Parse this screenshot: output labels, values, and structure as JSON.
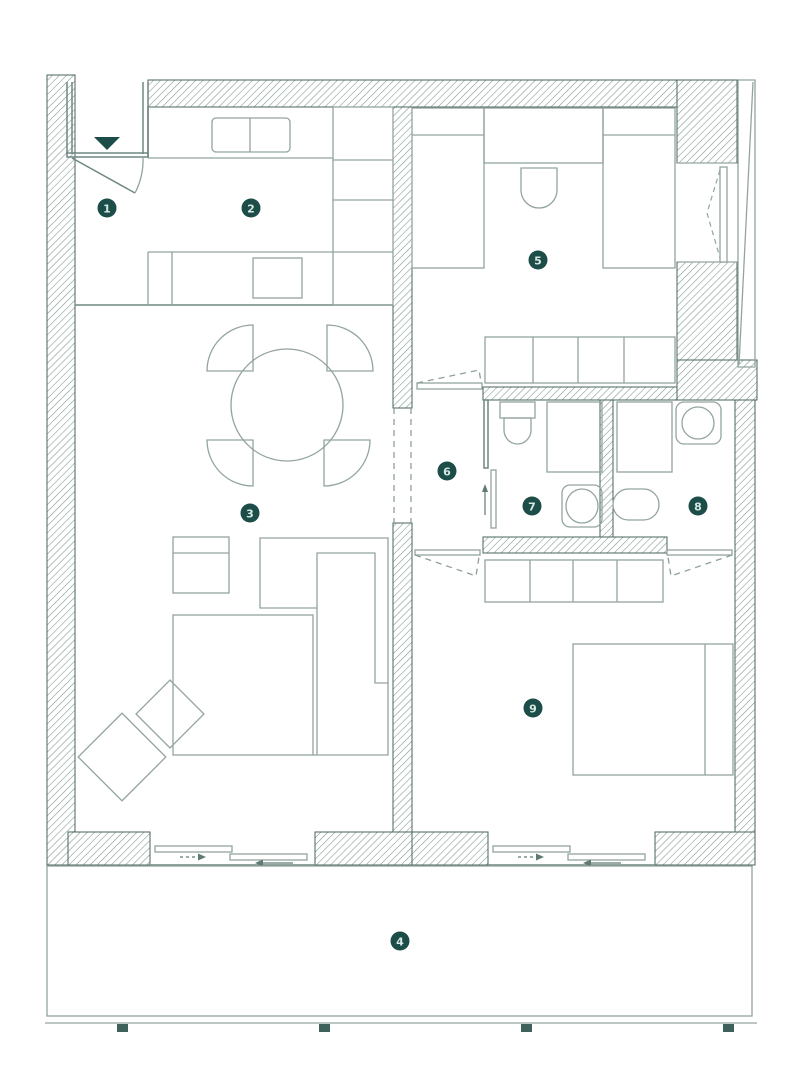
{
  "plan": {
    "type": "apartment-floor-plan",
    "rooms": [
      {
        "number": "1"
      },
      {
        "number": "2"
      },
      {
        "number": "3"
      },
      {
        "number": "4"
      },
      {
        "number": "5"
      },
      {
        "number": "6"
      },
      {
        "number": "7"
      },
      {
        "number": "8"
      },
      {
        "number": "9"
      }
    ],
    "colors": {
      "background": "#ffffff",
      "wall_outline": "#49655f",
      "wall_hatch": "#7b948e",
      "partition_line": "#6f8781",
      "furniture_line": "#93a49f",
      "badge_fill": "#1d4d48",
      "badge_text": "#d6e8e4"
    },
    "icons": [
      "entrance-arrow-icon",
      "door-swing-icon",
      "sliding-door-arrow-icon",
      "window-icon"
    ]
  }
}
